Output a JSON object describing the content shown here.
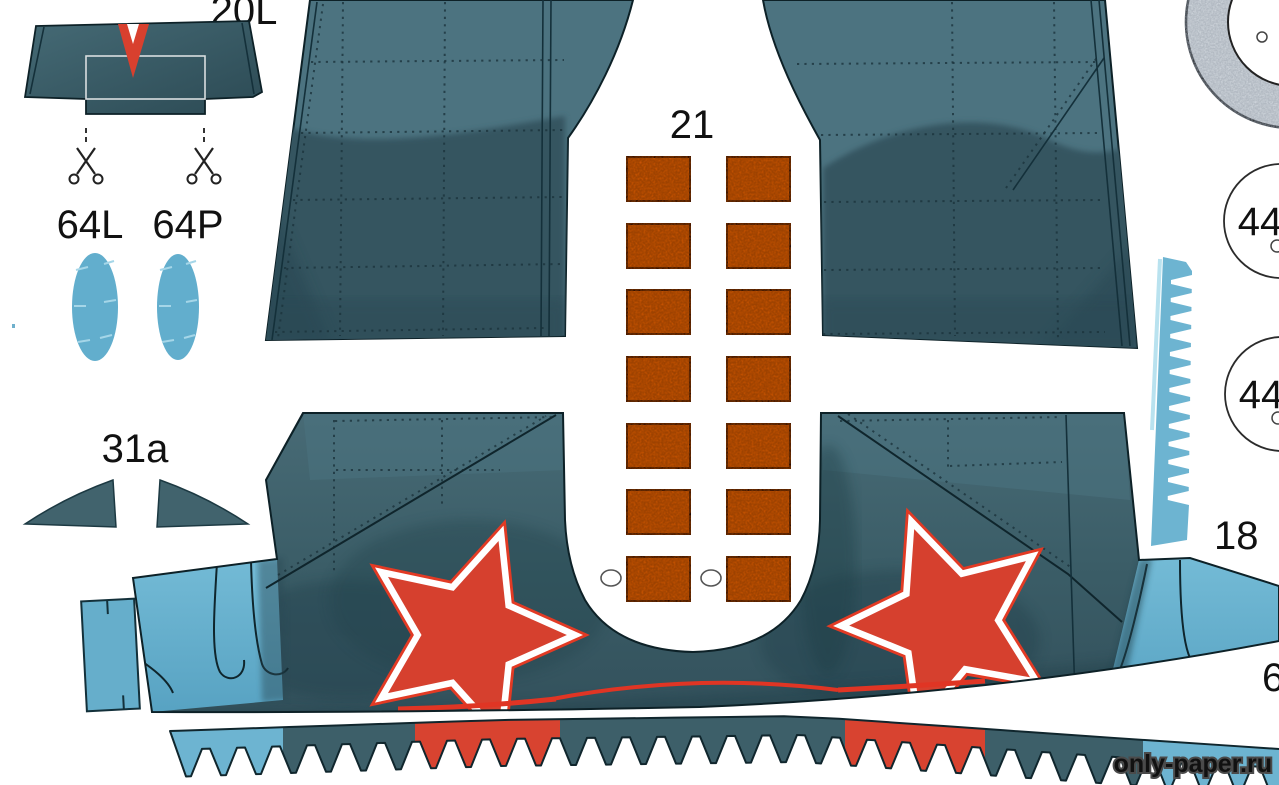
{
  "sheet": {
    "labels": {
      "part20l": "20L",
      "part64l": "64L",
      "part64p": "64P",
      "part31a": "31a",
      "part21": "21",
      "part44a": "44",
      "part44b": "44",
      "part18": "18",
      "part6partial": "6"
    },
    "watermark": "only-paper.ru",
    "part21_grid": {
      "cols": [
        627,
        727
      ],
      "row_ys": [
        157,
        224,
        290,
        357,
        424,
        490,
        557
      ],
      "rect_w": 63,
      "rect_h": 44
    },
    "colors": {
      "panel_light": "#4c7380",
      "panel_dark": "#345460",
      "band_teal": "#3d5f69",
      "band_deep": "#2f4c55",
      "light_blue": "#6db4d1",
      "orange": "#c4530f",
      "star_red": "#d6402e",
      "trim_red": "#e03524",
      "ring_gray": "#cfd5dc",
      "ink": "#0d2127"
    }
  }
}
